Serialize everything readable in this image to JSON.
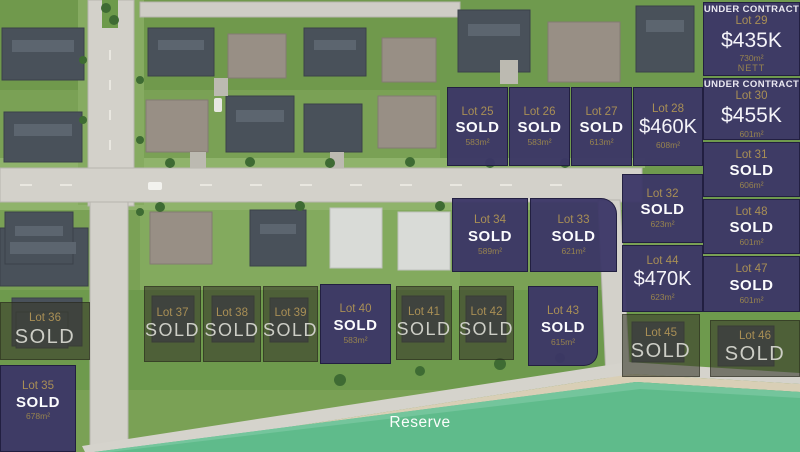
{
  "map": {
    "reserve_label": "Reserve"
  },
  "colors": {
    "parcel_navy": "#3b3666",
    "parcel_sold_overlay": "#393a2b",
    "gold_text": "#a98f55",
    "reserve_green": "#5fbb8b"
  },
  "lots": [
    {
      "id": "25",
      "label": "Lot 25",
      "status": "SOLD",
      "area": "583m²",
      "style": "navy"
    },
    {
      "id": "26",
      "label": "Lot 26",
      "status": "SOLD",
      "area": "583m²",
      "style": "navy"
    },
    {
      "id": "27",
      "label": "Lot 27",
      "status": "SOLD",
      "area": "613m²",
      "style": "navy"
    },
    {
      "id": "28",
      "label": "Lot 28",
      "price": "$460K",
      "area": "608m²",
      "style": "navy"
    },
    {
      "id": "29",
      "label": "Lot 29",
      "banner": "UNDER CONTRACT",
      "price": "$435K",
      "area": "730m²",
      "note": "NETT",
      "style": "navy"
    },
    {
      "id": "30",
      "label": "Lot 30",
      "banner": "UNDER CONTRACT",
      "price": "$455K",
      "area": "601m²",
      "style": "navy"
    },
    {
      "id": "31",
      "label": "Lot 31",
      "status": "SOLD",
      "area": "606m²",
      "style": "navy"
    },
    {
      "id": "48",
      "label": "Lot 48",
      "status": "SOLD",
      "area": "601m²",
      "style": "navy"
    },
    {
      "id": "47",
      "label": "Lot 47",
      "status": "SOLD",
      "area": "601m²",
      "style": "navy"
    },
    {
      "id": "46",
      "label": "Lot 46",
      "status": "SOLD",
      "style": "olive"
    },
    {
      "id": "32",
      "label": "Lot 32",
      "status": "SOLD",
      "area": "623m²",
      "style": "navy"
    },
    {
      "id": "44",
      "label": "Lot 44",
      "price": "$470K",
      "area": "623m²",
      "style": "navy"
    },
    {
      "id": "45",
      "label": "Lot 45",
      "status": "SOLD",
      "style": "olive"
    },
    {
      "id": "34",
      "label": "Lot 34",
      "status": "SOLD",
      "area": "589m²",
      "style": "navy"
    },
    {
      "id": "33",
      "label": "Lot 33",
      "status": "SOLD",
      "area": "621m²",
      "style": "navy"
    },
    {
      "id": "36",
      "label": "Lot 36",
      "status": "SOLD",
      "style": "olive"
    },
    {
      "id": "35",
      "label": "Lot 35",
      "status": "SOLD",
      "area": "678m²",
      "style": "navy"
    },
    {
      "id": "37",
      "label": "Lot 37",
      "status": "SOLD",
      "style": "olive"
    },
    {
      "id": "38",
      "label": "Lot 38",
      "status": "SOLD",
      "style": "olive"
    },
    {
      "id": "39",
      "label": "Lot 39",
      "status": "SOLD",
      "style": "olive"
    },
    {
      "id": "40",
      "label": "Lot 40",
      "status": "SOLD",
      "area": "583m²",
      "style": "navy"
    },
    {
      "id": "41",
      "label": "Lot 41",
      "status": "SOLD",
      "style": "olive"
    },
    {
      "id": "42",
      "label": "Lot 42",
      "status": "SOLD",
      "style": "olive"
    },
    {
      "id": "43",
      "label": "Lot 43",
      "status": "SOLD",
      "area": "615m²",
      "style": "navy"
    }
  ]
}
